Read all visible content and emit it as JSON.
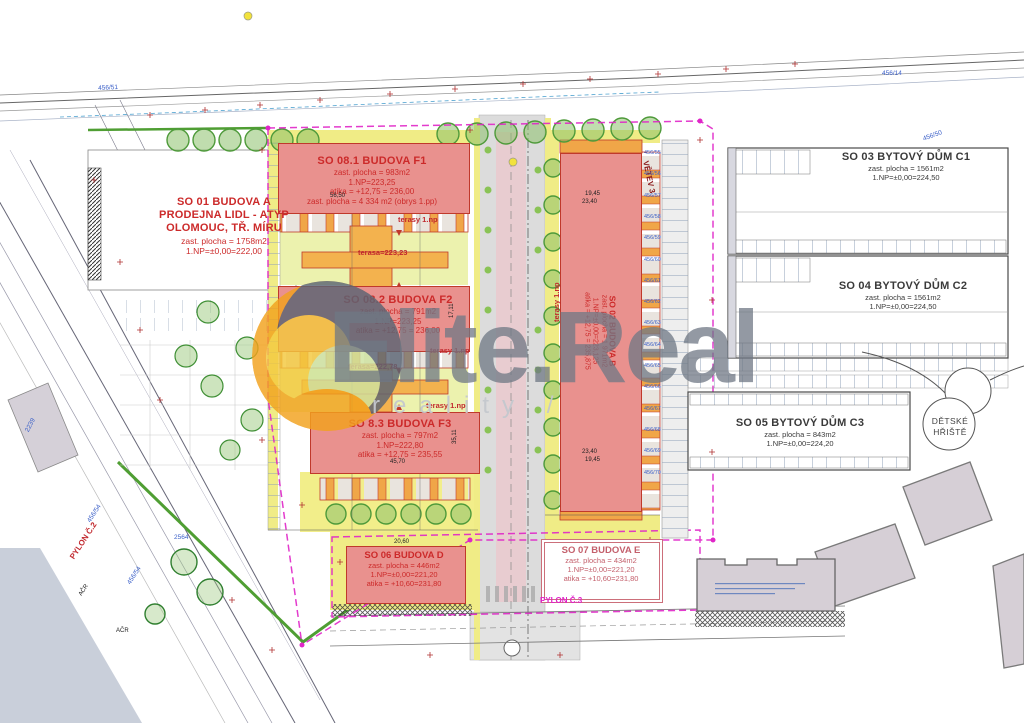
{
  "meta": {
    "colors": {
      "building_fill": "#e9918e",
      "building_border": "#c0392b",
      "yellow_path": "#f0ec86",
      "courtyard": "#ecf2ae",
      "terrace_orange": "#f3b24e",
      "boundary_magenta": "#e026c8",
      "boundary_green": "#4f9e33",
      "parcel_blue": "#3a5fc8",
      "watermark_gray": "#6f7885",
      "watermark_orange": "#f2a21d"
    }
  },
  "plan": {
    "buildings": [
      {
        "id": "so01",
        "lines": [
          "SO 01 BUDOVA A",
          "PRODEJNA LIDL - ATYP",
          "OLOMOUC, TŘ. MÍRU",
          "zast. plocha = 1758m2",
          "1.NP=±0,00=222,00"
        ]
      },
      {
        "id": "f1",
        "lines": [
          "SO 08.1  BUDOVA F1",
          "zast. plocha = 983m2",
          "1.NP=223,25",
          "atika = +12,75 = 236,00",
          "zast. plocha = 4 334 m2 (obrys 1.pp)"
        ]
      },
      {
        "id": "f2",
        "lines": [
          "SO 08.2  BUDOVA F2",
          "zast. plocha = 791m2",
          "1.NP=223,25",
          "atika = +12,75 = 236,00"
        ]
      },
      {
        "id": "f3",
        "lines": [
          "SO 8.3  BUDOVA F3",
          "zast. plocha = 797m2",
          "1.NP=222,80",
          "atika = +12,75 = 235,55"
        ]
      },
      {
        "id": "b",
        "lines": [
          "SO 02 BUDOVA B",
          "zast. plocha = 1 971m2",
          "1.NP=±0,00=223,125",
          "atika = +12,75 = 235,875"
        ]
      },
      {
        "id": "c1",
        "lines": [
          "SO 03 BYTOVÝ DŮM C1",
          "zast. plocha = 1561m2",
          "1.NP=±0,00=224,50"
        ]
      },
      {
        "id": "c2",
        "lines": [
          "SO 04 BYTOVÝ DŮM C2",
          "zast. plocha = 1561m2",
          "1.NP=±0,00=224,50"
        ]
      },
      {
        "id": "c3",
        "lines": [
          "SO 05 BYTOVÝ DŮM C3",
          "zast. plocha = 843m2",
          "1.NP=±0,00=224,20"
        ]
      },
      {
        "id": "d",
        "lines": [
          "SO 06 BUDOVA D",
          "zast. plocha = 446m2",
          "1.NP=±0,00=221,20",
          "atika = +10,60=231,80"
        ]
      },
      {
        "id": "e",
        "lines": [
          "SO 07 BUDOVA E",
          "zast. plocha = 434m2",
          "1.NP=±0,00=221,20",
          "atika = +10,60=231,80"
        ]
      }
    ],
    "playground": {
      "line1": "DĚTSKÉ",
      "line2": "HŘIŠTĚ"
    },
    "annotations": [
      {
        "text": "terasy 1.np",
        "x": 398,
        "y": 215,
        "cls": "a-red"
      },
      {
        "text": "terasy 1.np",
        "x": 430,
        "y": 346,
        "cls": "a-red"
      },
      {
        "text": "terasy 1.np",
        "x": 426,
        "y": 401,
        "cls": "a-red"
      },
      {
        "text": "terasy 1.np",
        "x": 552,
        "y": 322,
        "rot": -90,
        "cls": "a-red"
      },
      {
        "text": "terasa=223,23",
        "x": 358,
        "y": 248,
        "cls": "a-red"
      },
      {
        "text": "terasa=222,78",
        "x": 348,
        "y": 362,
        "cls": "a-red"
      },
      {
        "text": "PYLON Č.2",
        "x": 68,
        "y": 556,
        "rot": -57,
        "cls": "a-redb"
      },
      {
        "text": "PYLON Č.3",
        "x": 540,
        "y": 596,
        "cls": "a-mag"
      },
      {
        "text": "VĚTEV 3",
        "x": 650,
        "y": 160,
        "rot": 78,
        "cls": "a-darkred"
      },
      {
        "text": "456/51",
        "x": 98,
        "y": 85,
        "rot": -3,
        "cls": "a-blue"
      },
      {
        "text": "456/14",
        "x": 882,
        "y": 70,
        "cls": "a-blue"
      },
      {
        "text": "456/50",
        "x": 922,
        "y": 136,
        "rot": -20,
        "cls": "a-blue"
      },
      {
        "text": "456/54",
        "x": 86,
        "y": 520,
        "rot": -57,
        "cls": "a-blue"
      },
      {
        "text": "456/54",
        "x": 126,
        "y": 582,
        "rot": -57,
        "cls": "a-blue"
      },
      {
        "text": "AČR",
        "x": 78,
        "y": 594,
        "rot": -57,
        "cls": "a-dim"
      },
      {
        "text": "AČR",
        "x": 116,
        "y": 628,
        "cls": "a-dim"
      },
      {
        "text": "2239",
        "x": 24,
        "y": 430,
        "rot": -62,
        "cls": "a-blue"
      },
      {
        "text": "2564",
        "x": 174,
        "y": 534,
        "cls": "a-blue"
      },
      {
        "text": "56,50",
        "x": 330,
        "y": 193,
        "cls": "a-dim"
      },
      {
        "text": "19,45",
        "x": 585,
        "y": 191,
        "cls": "a-dim"
      },
      {
        "text": "23,40",
        "x": 582,
        "y": 199,
        "cls": "a-dim"
      },
      {
        "text": "23,40",
        "x": 582,
        "y": 449,
        "cls": "a-dim"
      },
      {
        "text": "19,45",
        "x": 585,
        "y": 457,
        "cls": "a-dim"
      },
      {
        "text": "45,70",
        "x": 390,
        "y": 459,
        "cls": "a-dim"
      },
      {
        "text": "20,60",
        "x": 394,
        "y": 539,
        "cls": "a-dim"
      },
      {
        "text": "17,11",
        "x": 449,
        "y": 318,
        "rot": -90,
        "cls": "a-dim"
      },
      {
        "text": "35,11",
        "x": 452,
        "y": 444,
        "rot": -90,
        "cls": "a-dim"
      }
    ],
    "parcel_column": {
      "x": 644,
      "y_start": 150,
      "step": 21.3,
      "values": [
        "456/55",
        "456/56",
        "456/57",
        "456/58",
        "456/59",
        "456/60",
        "456/61",
        "456/62",
        "456/63",
        "456/64",
        "456/65",
        "456/66",
        "456/67",
        "456/68",
        "456/69",
        "456/70"
      ]
    }
  },
  "watermark": {
    "brand_left": "Elite",
    "brand_dot": ".",
    "brand_right": "Real",
    "tagline": "reality /"
  }
}
